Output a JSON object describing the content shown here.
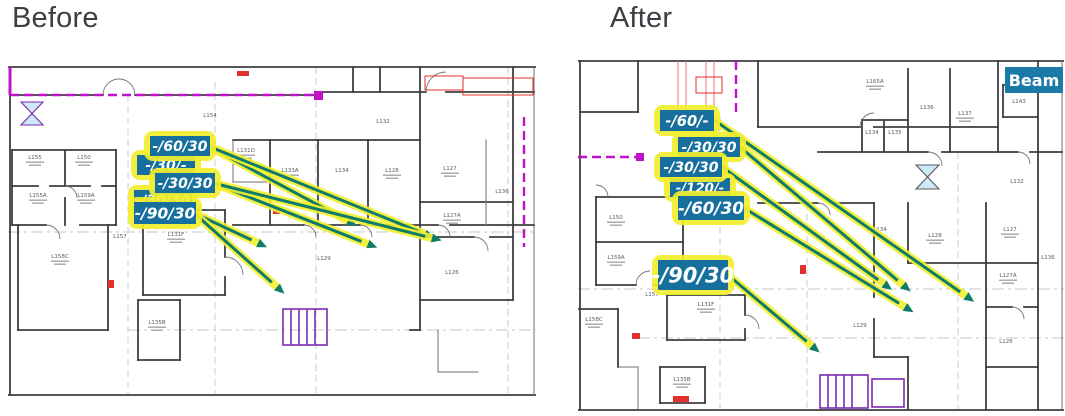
{
  "header": {
    "before_title": "Before",
    "after_title": "After"
  },
  "colors": {
    "callout_fill": "#176f9e",
    "callout_text": "#ffffff",
    "highlight_yellow": "#f2ee2f",
    "leader_teal": "#0d7b6a",
    "beam_fill": "#1c7aa8",
    "wall_gray": "#3e3e3e",
    "magenta": "#c013c9",
    "purple": "#7c2bb0",
    "red": "#e0312d",
    "room_text": "#5a5a5a"
  },
  "panels": {
    "before": {
      "rooms": [
        {
          "label": "L154",
          "x": 202,
          "y": 55,
          "sub": false
        },
        {
          "label": "L132",
          "x": 375,
          "y": 61,
          "sub": false
        },
        {
          "label": "L155",
          "x": 27,
          "y": 97,
          "sub": true
        },
        {
          "label": "L150",
          "x": 76,
          "y": 97,
          "sub": true
        },
        {
          "label": "L155A",
          "x": 30,
          "y": 135,
          "sub": true
        },
        {
          "label": "L159A",
          "x": 78,
          "y": 135,
          "sub": true
        },
        {
          "label": "L131D",
          "x": 238,
          "y": 90,
          "sub": true
        },
        {
          "label": "L133A",
          "x": 282,
          "y": 110,
          "sub": true
        },
        {
          "label": "L134",
          "x": 334,
          "y": 110,
          "sub": false
        },
        {
          "label": "L128",
          "x": 384,
          "y": 110,
          "sub": true
        },
        {
          "label": "L127",
          "x": 442,
          "y": 108,
          "sub": true
        },
        {
          "label": "L136",
          "x": 494,
          "y": 131,
          "sub": false
        },
        {
          "label": "L127A",
          "x": 444,
          "y": 155,
          "sub": true
        },
        {
          "label": "L126",
          "x": 444,
          "y": 212,
          "sub": false
        },
        {
          "label": "L157",
          "x": 112,
          "y": 176,
          "sub": false
        },
        {
          "label": "L131F",
          "x": 168,
          "y": 174,
          "sub": true
        },
        {
          "label": "L158C",
          "x": 52,
          "y": 196,
          "sub": true
        },
        {
          "label": "L129",
          "x": 316,
          "y": 198,
          "sub": false
        },
        {
          "label": "L135B",
          "x": 149,
          "y": 262,
          "sub": true
        }
      ],
      "callouts": [
        {
          "text": "-/30/-",
          "x": 129,
          "y": 93,
          "w": 58,
          "h": 20,
          "behind": true
        },
        {
          "text": "-/30/30",
          "x": 126,
          "y": 128,
          "w": 58,
          "h": 20,
          "behind": true
        },
        {
          "text": "-/60/30",
          "x": 142,
          "y": 74,
          "w": 60,
          "h": 20,
          "behind": false
        },
        {
          "text": "-/30/30",
          "x": 147,
          "y": 111,
          "w": 60,
          "h": 20,
          "behind": false
        },
        {
          "text": "-/90/30",
          "x": 126,
          "y": 140,
          "w": 62,
          "h": 22,
          "behind": false
        }
      ],
      "leaders": [
        {
          "x1": 200,
          "y1": 84,
          "x2": 340,
          "y2": 159
        },
        {
          "x1": 200,
          "y1": 84,
          "x2": 417,
          "y2": 172
        },
        {
          "x1": 205,
          "y1": 121,
          "x2": 360,
          "y2": 182
        },
        {
          "x1": 205,
          "y1": 121,
          "x2": 424,
          "y2": 176
        },
        {
          "x1": 186,
          "y1": 151,
          "x2": 250,
          "y2": 181
        },
        {
          "x1": 186,
          "y1": 151,
          "x2": 269,
          "y2": 225
        }
      ]
    },
    "after": {
      "rooms": [
        {
          "label": "L165A",
          "x": 297,
          "y": 26,
          "sub": true
        },
        {
          "label": "L136",
          "x": 349,
          "y": 52,
          "sub": false
        },
        {
          "label": "L137",
          "x": 387,
          "y": 58,
          "sub": true
        },
        {
          "label": "L134",
          "x": 294,
          "y": 77,
          "sub": false
        },
        {
          "label": "L135",
          "x": 317,
          "y": 77,
          "sub": false
        },
        {
          "label": "L143",
          "x": 441,
          "y": 46,
          "sub": false
        },
        {
          "label": "L132",
          "x": 439,
          "y": 126,
          "sub": false
        },
        {
          "label": "L150",
          "x": 38,
          "y": 162,
          "sub": true
        },
        {
          "label": "L159A",
          "x": 38,
          "y": 202,
          "sub": true
        },
        {
          "label": "L157",
          "x": 74,
          "y": 239,
          "sub": false
        },
        {
          "label": "L158C",
          "x": 16,
          "y": 264,
          "sub": true
        },
        {
          "label": "L131F",
          "x": 128,
          "y": 249,
          "sub": true
        },
        {
          "label": "L135B",
          "x": 104,
          "y": 324,
          "sub": true
        },
        {
          "label": "L129",
          "x": 282,
          "y": 270,
          "sub": false
        },
        {
          "label": "L134",
          "x": 302,
          "y": 174,
          "sub": false
        },
        {
          "label": "L128",
          "x": 357,
          "y": 180,
          "sub": true
        },
        {
          "label": "L127",
          "x": 432,
          "y": 174,
          "sub": true
        },
        {
          "label": "L127A",
          "x": 430,
          "y": 220,
          "sub": true
        },
        {
          "label": "L126",
          "x": 428,
          "y": 286,
          "sub": false
        },
        {
          "label": "L136",
          "x": 470,
          "y": 202,
          "sub": false
        }
      ],
      "callouts": [
        {
          "text": "-/120/-",
          "x": 92,
          "y": 121,
          "w": 60,
          "h": 19,
          "behind": true
        },
        {
          "text": "-/60/-",
          "x": 82,
          "y": 53,
          "w": 54,
          "h": 21,
          "behind": false
        },
        {
          "text": "-/30/30",
          "x": 100,
          "y": 80,
          "w": 62,
          "h": 20,
          "behind": false
        },
        {
          "text": "-/30/30",
          "x": 82,
          "y": 100,
          "w": 62,
          "h": 20,
          "behind": false
        },
        {
          "text": "-/60/30",
          "x": 100,
          "y": 139,
          "w": 66,
          "h": 24,
          "behind": false
        },
        {
          "text": "-/90/30",
          "x": 80,
          "y": 203,
          "w": 70,
          "h": 30,
          "behind": false
        }
      ],
      "leaders": [
        {
          "x1": 136,
          "y1": 63,
          "x2": 388,
          "y2": 239
        },
        {
          "x1": 162,
          "y1": 90,
          "x2": 325,
          "y2": 228
        },
        {
          "x1": 144,
          "y1": 110,
          "x2": 306,
          "y2": 227
        },
        {
          "x1": 166,
          "y1": 151,
          "x2": 327,
          "y2": 250
        },
        {
          "x1": 150,
          "y1": 218,
          "x2": 234,
          "y2": 289
        }
      ],
      "beam": {
        "label": "Beam",
        "x": 427,
        "y": 10,
        "w": 58,
        "h": 26
      }
    }
  }
}
